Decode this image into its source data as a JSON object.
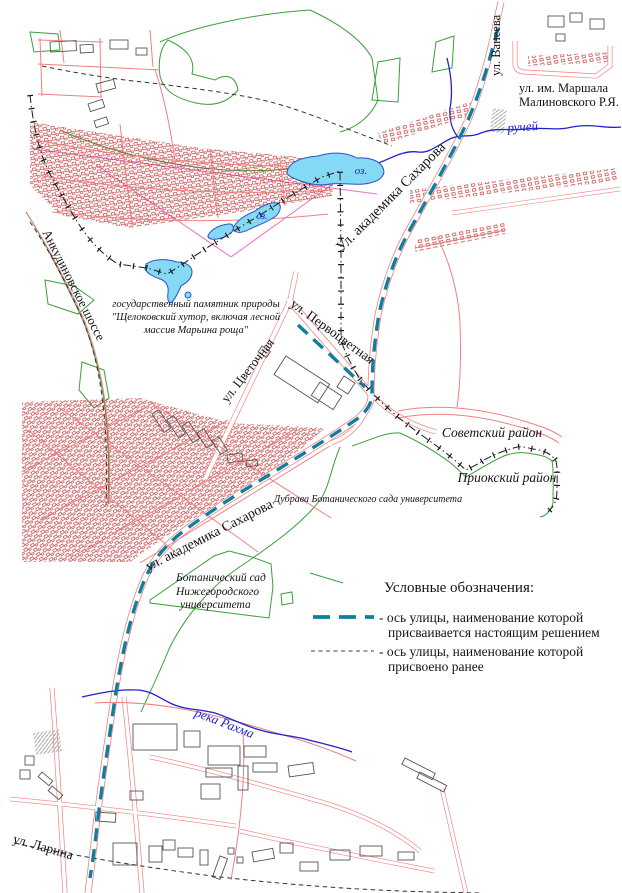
{
  "colors": {
    "new_axis": "#0e7f9e",
    "old_axis": "#1a1a1a",
    "road": "#f08080",
    "houses": "#bf4040",
    "buildings": "#555555",
    "water": "#2222cc",
    "lake_fill": "#85d9f5",
    "lake_stroke": "#2a52c8",
    "green": "#3aa03a",
    "magenta": "#ee6fc8",
    "hatch": "#999999"
  },
  "labels": {
    "vaneeva": "ул. Ванеева",
    "malinovsky1": "ул. им. Маршала",
    "malinovsky2": "Малиновского Р.Я.",
    "ruchey": "ручей",
    "oz_big": "оз.",
    "oz_mid": "оз.",
    "sakharova_upper": "Ул. академика Сахарова",
    "sakharova_lower": "ул. академика Сахарова",
    "ankudinovskoe": "Анкудиновское шоссе",
    "tsvetochnaya": "ул. Цветочная",
    "pervotsvetnaya": "ул. Первоцветная",
    "monument1": "государственный памятник природы",
    "monument2": "\"Щелоковский хутор, включая лесной",
    "monument3": "массив Марьина роща\"",
    "sovetsky_district": "Советский район",
    "prioksky_district": "Приокский район",
    "dubrava": "Дубрава Ботанического сада университета",
    "botsad1": "Ботанический сад",
    "botsad2": "Нижегородского",
    "botsad3": "университета",
    "rakhma": "река Рахма",
    "larina": "ул. Ларина"
  },
  "legend": {
    "title": "Условные обозначения:",
    "new_axis_label1": "- ось улицы, наименование которой",
    "new_axis_label2": "присваивается настоящим решением",
    "old_axis_label1": "- ось улицы, наименование которой",
    "old_axis_label2": "присвоено ранее"
  }
}
